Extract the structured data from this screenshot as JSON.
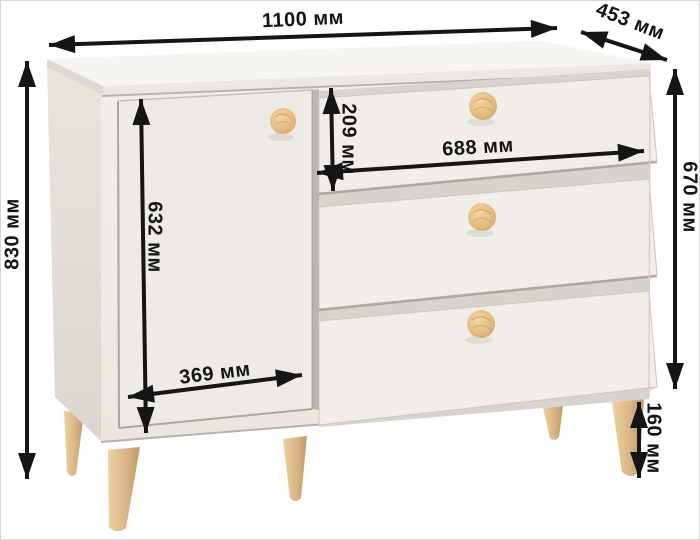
{
  "diagram": {
    "type": "furniture-dimension-diagram",
    "subject": "chest-of-drawers-with-door",
    "unit": "мм",
    "colors": {
      "arrow": "#151515",
      "label_text": "#141414",
      "body": "#efece7",
      "body_top": "#f7f5f1",
      "side_panel": "#e5e1da",
      "recess_shadow": "#d8d4cd",
      "wood_knob": "#e2b97f",
      "wood_leg": "#d9b587",
      "background": "#fefefe"
    },
    "dimensions": {
      "overall_width": {
        "value": 1100,
        "label": "1100 мм"
      },
      "overall_depth": {
        "value": 453,
        "label": "453 мм"
      },
      "overall_height": {
        "value": 830,
        "label": "830 мм"
      },
      "body_height": {
        "value": 670,
        "label": "670 мм"
      },
      "top_drawer_height": {
        "value": 209,
        "label": "209 мм"
      },
      "drawer_width": {
        "value": 688,
        "label": "688 мм"
      },
      "door_height": {
        "value": 632,
        "label": "632 мм"
      },
      "door_width": {
        "value": 369,
        "label": "369 мм"
      },
      "leg_height": {
        "value": 160,
        "label": "160 мм"
      }
    }
  }
}
